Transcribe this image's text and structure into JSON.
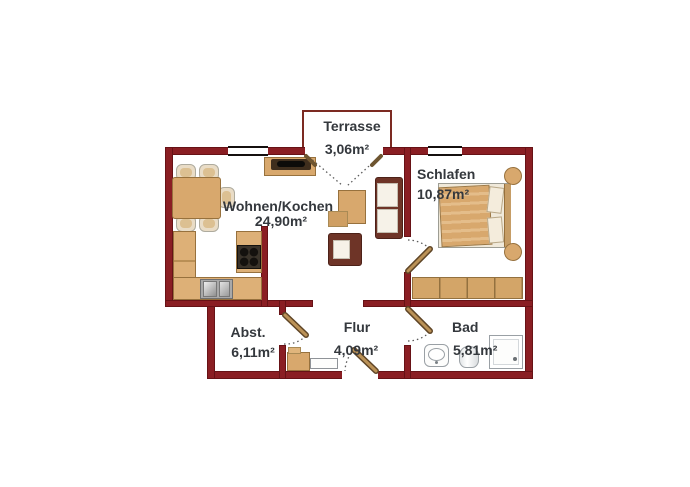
{
  "rooms": [
    {
      "name": "Terrasse",
      "area": "3,06m²"
    },
    {
      "name": "Wohnen/Kochen",
      "area": "24,90m²"
    },
    {
      "name": "Schlafen",
      "area": "10,87m²"
    },
    {
      "name": "Abst.",
      "area": "6,11m²"
    },
    {
      "name": "Flur",
      "area": "4,09m²"
    },
    {
      "name": "Bad",
      "area": "5,81m²"
    }
  ],
  "colors": {
    "wall": "#8a1e23",
    "wood": "#d8a86d",
    "wood_border": "#97713d",
    "sofa_frame": "#6e3427",
    "label_text": "#34383d",
    "background": "#ffffff"
  },
  "furniture": [
    "dining-table",
    "dining-chairs",
    "tv-sideboard",
    "kitchen-counter",
    "kitchen-sink",
    "stove",
    "sofa",
    "armchair",
    "coffee-table",
    "side-table",
    "double-bed",
    "pillows",
    "nightstands",
    "wardrobe",
    "hall-cabinet",
    "hall-bench",
    "washbasin",
    "toilet",
    "shower"
  ],
  "doors": [
    "terrace-french-door",
    "bedroom-door",
    "bathroom-door",
    "storage-door",
    "entrance-door"
  ],
  "window_count": 2
}
